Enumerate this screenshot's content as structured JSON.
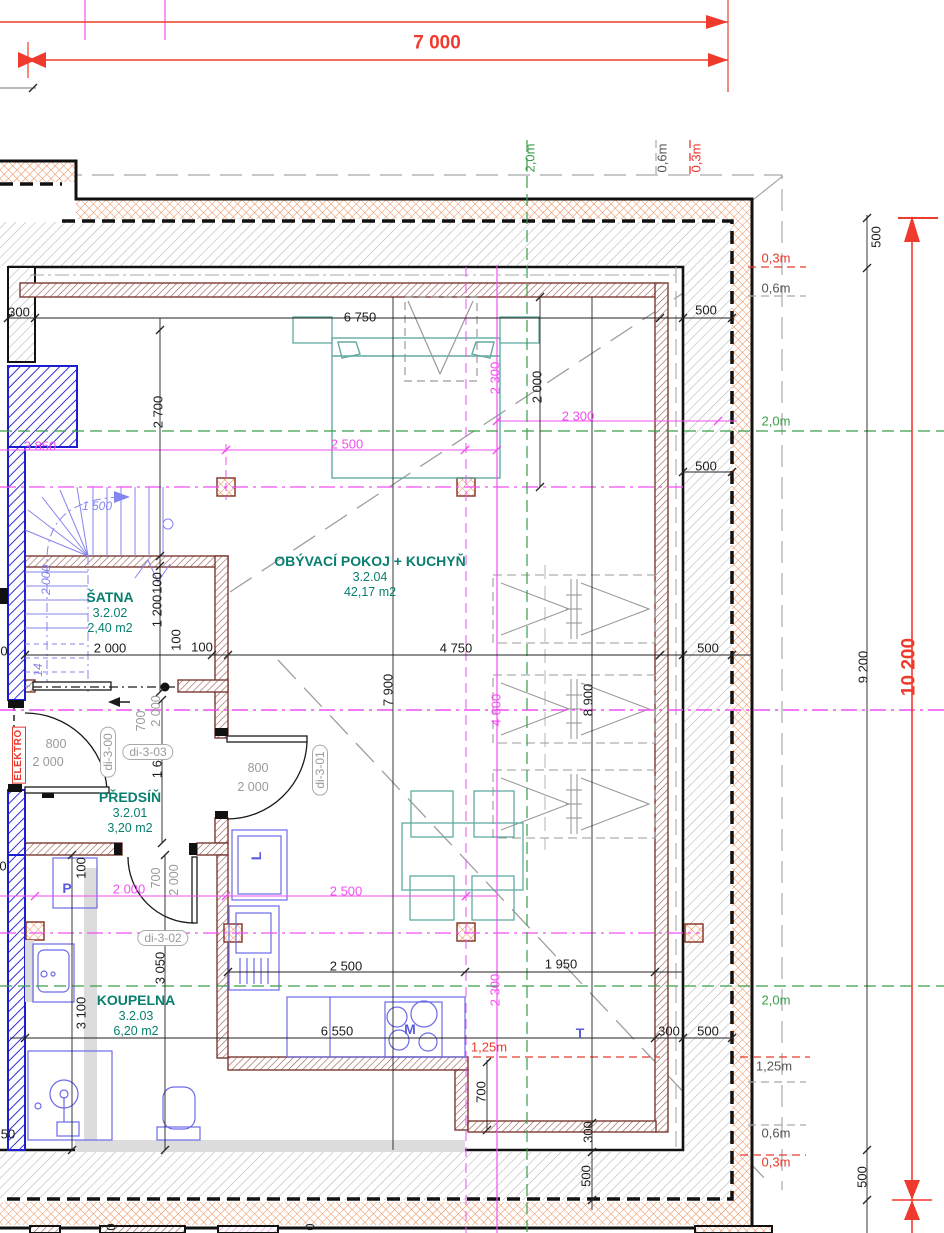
{
  "drawing": {
    "type": "floor-plan",
    "colors": {
      "dimension_red": "#ef3b2d",
      "magenta": "#f24ff2",
      "green": "#3a9e4a",
      "room_teal": "#087f6f",
      "fixture_blue": "#6a6ae8",
      "wall_brown": "#7a3a33",
      "insulation_orange": "#ea8c55"
    },
    "rooms": [
      {
        "id": "satna",
        "name": "ŠATNA",
        "number": "3.2.02",
        "area": "2,40 m2",
        "x": 110,
        "y": 597
      },
      {
        "id": "obyvaci",
        "name": "OBÝVACÍ POKOJ + KUCHYŇ",
        "number": "3.2.04",
        "area": "42,17 m2",
        "x": 370,
        "y": 561
      },
      {
        "id": "predsin",
        "name": "PŘEDSÍŇ",
        "number": "3.2.01",
        "area": "3,20 m2",
        "x": 130,
        "y": 797
      },
      {
        "id": "koupelna",
        "name": "KOUPELNA",
        "number": "3.2.03",
        "area": "6,20 m2",
        "x": 136,
        "y": 1000
      }
    ],
    "labels": [
      {
        "n": "dim-7000",
        "t": "7 000",
        "x": 437,
        "y": 43,
        "c": "kb"
      },
      {
        "n": "dim-500-right-top",
        "t": "500",
        "x": 876,
        "y": 237,
        "c": "k",
        "r": -90
      },
      {
        "n": "dim-9200",
        "t": "9 200",
        "x": 863,
        "y": 667,
        "c": "k",
        "r": -90
      },
      {
        "n": "dim-10200",
        "t": "10 200",
        "x": 909,
        "y": 667,
        "c": "kb",
        "r": -90
      },
      {
        "n": "dim-500-right-bottom",
        "t": "500",
        "x": 862,
        "y": 1177,
        "c": "k",
        "r": -90
      },
      {
        "n": "offset-2-0m-top",
        "t": "2,0m",
        "x": 530,
        "y": 158,
        "c": "g",
        "r": -90
      },
      {
        "n": "offset-0-6m-top",
        "t": "0,6m",
        "x": 662,
        "y": 158,
        "c": "gyd",
        "r": -90
      },
      {
        "n": "offset-0-3m-top",
        "t": "0,3m",
        "x": 696,
        "y": 158,
        "c": "rd",
        "r": -90
      },
      {
        "n": "offset-0-3m-right-1",
        "t": "0,3m",
        "x": 776,
        "y": 258,
        "c": "rd"
      },
      {
        "n": "offset-0-6m-right-1",
        "t": "0,6m",
        "x": 776,
        "y": 288,
        "c": "gyd"
      },
      {
        "n": "offset-2-0m-right-1",
        "t": "2,0m",
        "x": 776,
        "y": 421,
        "c": "g"
      },
      {
        "n": "offset-2-0m-right-2",
        "t": "2,0m",
        "x": 776,
        "y": 1000,
        "c": "g"
      },
      {
        "n": "offset-1-25m-right",
        "t": "1,25m",
        "x": 774,
        "y": 1066,
        "c": "gyd"
      },
      {
        "n": "offset-0-6m-right-2",
        "t": "0,6m",
        "x": 776,
        "y": 1133,
        "c": "gyd"
      },
      {
        "n": "offset-0-3m-right-2",
        "t": "0,3m",
        "x": 776,
        "y": 1162,
        "c": "rd"
      },
      {
        "n": "dim-6750",
        "t": "6 750",
        "x": 360,
        "y": 317,
        "c": "k"
      },
      {
        "n": "dim-2700",
        "t": "2 700",
        "x": 158,
        "y": 412,
        "c": "k",
        "r": -90
      },
      {
        "n": "dim-2000-bed",
        "t": "2 000",
        "x": 537,
        "y": 387,
        "c": "k",
        "r": -90
      },
      {
        "n": "dim-2300-v",
        "t": "2 300",
        "x": 495,
        "y": 378,
        "c": "m",
        "r": -90
      },
      {
        "n": "dim-2300-h",
        "t": "2 300",
        "x": 578,
        "y": 416,
        "c": "m"
      },
      {
        "n": "dim-2500-top",
        "t": "2 500",
        "x": 347,
        "y": 444,
        "c": "m"
      },
      {
        "n": "dim-3850",
        "t": "3 850",
        "x": 40,
        "y": 446,
        "c": "m"
      },
      {
        "n": "dim-1500-stairs",
        "t": "1 500",
        "x": 97,
        "y": 506,
        "c": "bl"
      },
      {
        "n": "dim-2000-stairs",
        "t": "2 000",
        "x": 46,
        "y": 580,
        "c": "bl",
        "r": -90
      },
      {
        "n": "dim-500-a",
        "t": "500",
        "x": 706,
        "y": 310,
        "c": "k"
      },
      {
        "n": "dim-500-b",
        "t": "500",
        "x": 706,
        "y": 466,
        "c": "k"
      },
      {
        "n": "dim-500-c",
        "t": "500",
        "x": 708,
        "y": 648,
        "c": "k"
      },
      {
        "n": "dim-4750",
        "t": "4 750",
        "x": 456,
        "y": 648,
        "c": "k"
      },
      {
        "n": "dim-2000-satna",
        "t": "2 000",
        "x": 110,
        "y": 648,
        "c": "k"
      },
      {
        "n": "dim-100-a",
        "t": "100",
        "x": 202,
        "y": 647,
        "c": "k"
      },
      {
        "n": "dim-100-b",
        "t": "100",
        "x": 176,
        "y": 640,
        "c": "k",
        "r": -90
      },
      {
        "n": "dim-100-c",
        "t": "100",
        "x": 157,
        "y": 583,
        "c": "k",
        "r": -90
      },
      {
        "n": "dim-1200",
        "t": "1 200",
        "x": 157,
        "y": 611,
        "c": "k",
        "r": -90
      },
      {
        "n": "dim-300-left",
        "t": "300",
        "x": 19,
        "y": 312,
        "c": "k"
      },
      {
        "n": "dim-7900",
        "t": "7 900",
        "x": 388,
        "y": 690,
        "c": "k",
        "r": -90
      },
      {
        "n": "dim-8900",
        "t": "8 900",
        "x": 588,
        "y": 700,
        "c": "k",
        "r": -90
      },
      {
        "n": "dim-4600",
        "t": "4 600",
        "x": 496,
        "y": 710,
        "c": "m",
        "r": -90
      },
      {
        "n": "dim-1600",
        "t": "1 600",
        "x": 157,
        "y": 762,
        "c": "k",
        "r": -90
      },
      {
        "n": "dim-700-door3",
        "t": "700",
        "x": 141,
        "y": 721,
        "c": "gy",
        "r": -90
      },
      {
        "n": "dim-2000-door3",
        "t": "2 000",
        "x": 156,
        "y": 711,
        "c": "gy",
        "r": -90
      },
      {
        "n": "dim-800-d0",
        "t": "800",
        "x": 56,
        "y": 744,
        "c": "gy"
      },
      {
        "n": "dim-2000-d0",
        "t": "2 000",
        "x": 48,
        "y": 762,
        "c": "gy"
      },
      {
        "n": "door-label-di-3-00",
        "t": "di-3-00",
        "x": 108,
        "y": 752,
        "c": "ov",
        "r": -90
      },
      {
        "n": "door-label-di-3-03",
        "t": "di-3-03",
        "x": 148,
        "y": 752,
        "c": "ov"
      },
      {
        "n": "dim-800-d1",
        "t": "800",
        "x": 258,
        "y": 768,
        "c": "gy"
      },
      {
        "n": "dim-2000-d1",
        "t": "2 000",
        "x": 253,
        "y": 787,
        "c": "gy"
      },
      {
        "n": "door-label-di-3-01",
        "t": "di-3-01",
        "x": 320,
        "y": 770,
        "c": "ov",
        "r": -90
      },
      {
        "n": "elektro-label",
        "t": "ELEKTRO",
        "x": 19,
        "y": 755,
        "c": "el",
        "r": -90
      },
      {
        "n": "dim-2000-koupelna",
        "t": "2 000",
        "x": 129,
        "y": 889,
        "c": "m"
      },
      {
        "n": "dim-700-d2",
        "t": "700",
        "x": 156,
        "y": 878,
        "c": "gy",
        "r": -90
      },
      {
        "n": "dim-2000-d2",
        "t": "2 000",
        "x": 174,
        "y": 880,
        "c": "gy",
        "r": -90
      },
      {
        "n": "door-label-di-3-02",
        "t": "di-3-02",
        "x": 163,
        "y": 938,
        "c": "ov"
      },
      {
        "n": "dim-100-koupelna",
        "t": "100",
        "x": 81,
        "y": 868,
        "c": "k",
        "r": -90
      },
      {
        "n": "dim-2500-mag-low",
        "t": "2 500",
        "x": 346,
        "y": 891,
        "c": "m"
      },
      {
        "n": "dim-2500-low",
        "t": "2 500",
        "x": 346,
        "y": 966,
        "c": "k"
      },
      {
        "n": "dim-1950",
        "t": "1 950",
        "x": 561,
        "y": 964,
        "c": "k"
      },
      {
        "n": "dim-6550",
        "t": "6 550",
        "x": 337,
        "y": 1031,
        "c": "k"
      },
      {
        "n": "dim-300-br",
        "t": "300",
        "x": 669,
        "y": 1031,
        "c": "k"
      },
      {
        "n": "dim-500-br",
        "t": "500",
        "x": 708,
        "y": 1031,
        "c": "k"
      },
      {
        "n": "dim-2300-low",
        "t": "2 300",
        "x": 495,
        "y": 990,
        "c": "m",
        "r": -90
      },
      {
        "n": "offset-1-25m-inner",
        "t": "1,25m",
        "x": 489,
        "y": 1047,
        "c": "rd"
      },
      {
        "n": "dim-700-step",
        "t": "700",
        "x": 481,
        "y": 1092,
        "c": "k",
        "r": -90
      },
      {
        "n": "dim-3050",
        "t": "3 050",
        "x": 160,
        "y": 968,
        "c": "k",
        "r": -90
      },
      {
        "n": "dim-3100",
        "t": "3 100",
        "x": 81,
        "y": 1013,
        "c": "k",
        "r": -90
      },
      {
        "n": "dim-300-step",
        "t": "300",
        "x": 588,
        "y": 1132,
        "c": "k",
        "r": -90
      },
      {
        "n": "dim-500-bottom",
        "t": "500",
        "x": 586,
        "y": 1176,
        "c": "k",
        "r": -90
      },
      {
        "n": "dim-cut-50",
        "t": "50",
        "x": 8,
        "y": 1134,
        "c": "k"
      },
      {
        "n": "dim-cut-0-a",
        "t": "0",
        "x": 4,
        "y": 651,
        "c": "k"
      },
      {
        "n": "dim-cut-0-b",
        "t": "0",
        "x": 3,
        "y": 866,
        "c": "k"
      },
      {
        "n": "dim-14-stairs",
        "t": "14",
        "x": 38,
        "y": 670,
        "c": "bl",
        "r": -90
      },
      {
        "n": "appliance-label-m",
        "t": "M",
        "x": 410,
        "y": 1029,
        "c": "blb"
      },
      {
        "n": "appliance-label-t",
        "t": "T",
        "x": 580,
        "y": 1033,
        "c": "blb"
      },
      {
        "n": "appliance-label-p",
        "t": "P",
        "x": 67,
        "y": 888,
        "c": "blb"
      },
      {
        "n": "appliance-label-l",
        "t": "L",
        "x": 256,
        "y": 856,
        "c": "blb",
        "r": -90
      },
      {
        "n": "dim-cut-0-c",
        "t": "0",
        "x": 111,
        "y": 1227,
        "c": "k",
        "r": -90
      },
      {
        "n": "dim-cut-0-d",
        "t": "0",
        "x": 310,
        "y": 1227,
        "c": "k",
        "r": -90
      }
    ]
  }
}
